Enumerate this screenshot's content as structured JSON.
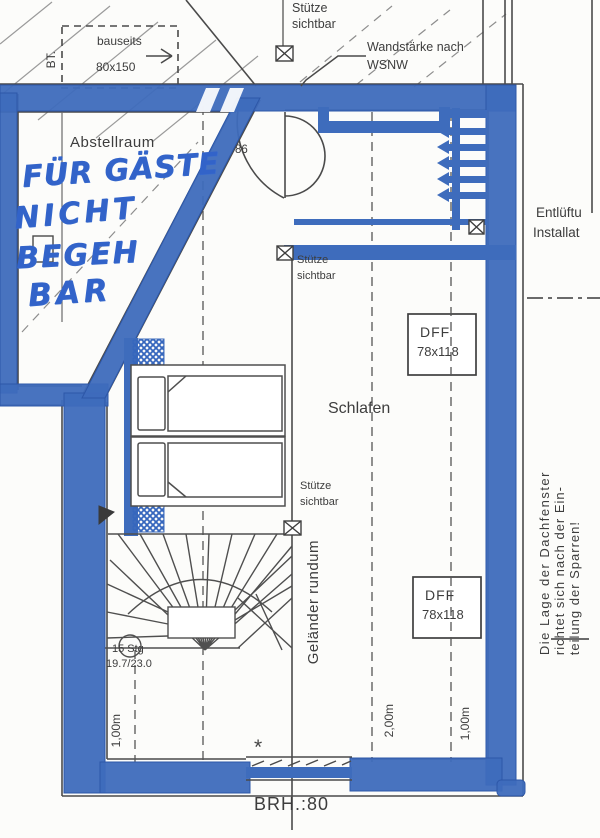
{
  "colors": {
    "wall_blue": "#3e6cbc",
    "marker_blue": "#3263c9",
    "line_dark": "#4a4a4a"
  },
  "plan": {
    "rooms": {
      "storage": "Abstellraum",
      "bedroom": "Schlafen"
    },
    "handwritten_note": [
      "FÜR GÄSTE",
      "NICHT",
      "BEGEH",
      "BAR"
    ],
    "labels": {
      "support_visible": [
        "Stütze",
        "sichtbar"
      ],
      "wall_thickness": [
        "Wandstärke nach",
        "WSNW"
      ],
      "client_provided": "bauseits",
      "client_provided_size": "80x150",
      "bt": "BT.",
      "door_width": "86",
      "venting": [
        "Entlüftu",
        "Installat"
      ],
      "roof_window_type": "DFF",
      "roof_window_size": "78x118",
      "railing": "Geländer rundum",
      "stair_risers": "15 Stg",
      "stair_ratio": "19.7/23.0",
      "dim_left": "1,00m",
      "dim_middle": "2,00m",
      "dim_right": "1,00m",
      "sill_height": "BRH.:80",
      "asterisk": "*",
      "rafter_note": [
        "Die Lage der Dachfenster",
        "richtet sich nach der Ein-",
        "teilung der Sparren!"
      ]
    }
  }
}
